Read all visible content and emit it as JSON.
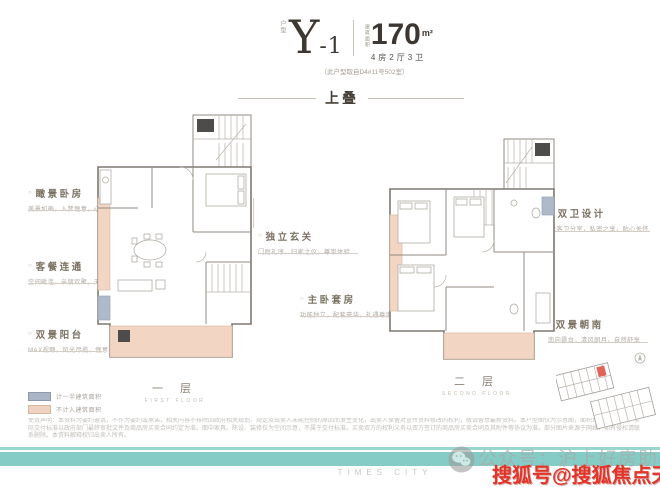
{
  "header": {
    "type_label": "户型",
    "unit_name_main": "Y",
    "unit_name_suffix": "-1",
    "area_label": "建筑面积",
    "area_value": "170",
    "area_unit": "m²",
    "rooms_spec": "4房2厅3卫",
    "source_note": "（此户型取自D4#11号502室）",
    "section_title": "上叠"
  },
  "annotations": {
    "left": [
      {
        "marker": "○",
        "title": "瞰景卧房",
        "desc": "美景如画，入梦惬意，心旷神怡"
      },
      {
        "marker": "○",
        "title": "客餐连通",
        "desc": "空间毗连，亲朋欢聚，天伦相伴"
      },
      {
        "marker": "○",
        "title": "双景阳台",
        "desc": "MAX视野，风光尽揽，惬意栖居"
      }
    ],
    "right": [
      {
        "marker": "○",
        "title": "独立玄关",
        "desc": "门庭礼序，归家之仪，尊崇体验"
      },
      {
        "marker": "○",
        "title": "主卧套房",
        "desc": "功能独立，配套豪华，礼遇尊崇"
      },
      {
        "marker": "○",
        "title": "双卫设计",
        "desc": "主客卫分室，私密之享，贴心关怀"
      },
      {
        "marker": "○",
        "title": "双景朝南",
        "desc": "南向露台，清风朗月，自然舒享"
      }
    ]
  },
  "floors": [
    {
      "label": "一 层",
      "sublabel": "FIRST FLOOR"
    },
    {
      "label": "二 层",
      "sublabel": "SECOND FLOOR"
    }
  ],
  "legend": {
    "items": [
      {
        "label": "计一半建筑面积",
        "color": "#a9b4c5"
      },
      {
        "label": "不计入建筑面积",
        "color": "#f0d2c0"
      }
    ]
  },
  "disclaimer": "免责声明：本资料为要约邀请，不作为要约或承诺，相关内容不排除因政府相关规划、规定及出卖人未能控制的原因而发生变化，出卖人保留对宣传资料修改的权利，敬请留意最新资料。本户型图仅为示意图，面积均为建筑面积，实际交付标准以政府部门最终审批文件及商品房买卖合同约定为准。图中家具、陈设、装修仅为空间示意，不属于交付标准。买卖双方的权利义务以双方签订的商品房买卖合同及其附件等协议为准。部分图片来源于网络，如有侵权请联系删除。本资料解释权归出卖人所有。",
  "footer": {
    "brand": "TIMES CITY",
    "wechat_watermark": "公众号：沪上好房助手",
    "sohu_watermark": "搜狐号@搜狐焦点天门站"
  },
  "icons": {
    "wechat": "wechat-icon",
    "compass": "compass-icon"
  },
  "colors": {
    "accent_teal": "#84ccc5",
    "balcony_pink": "#f0d2c0",
    "half_area_blue": "#a9b4c5",
    "watermark_red": "#e23427",
    "title_brown": "#7b7163"
  }
}
